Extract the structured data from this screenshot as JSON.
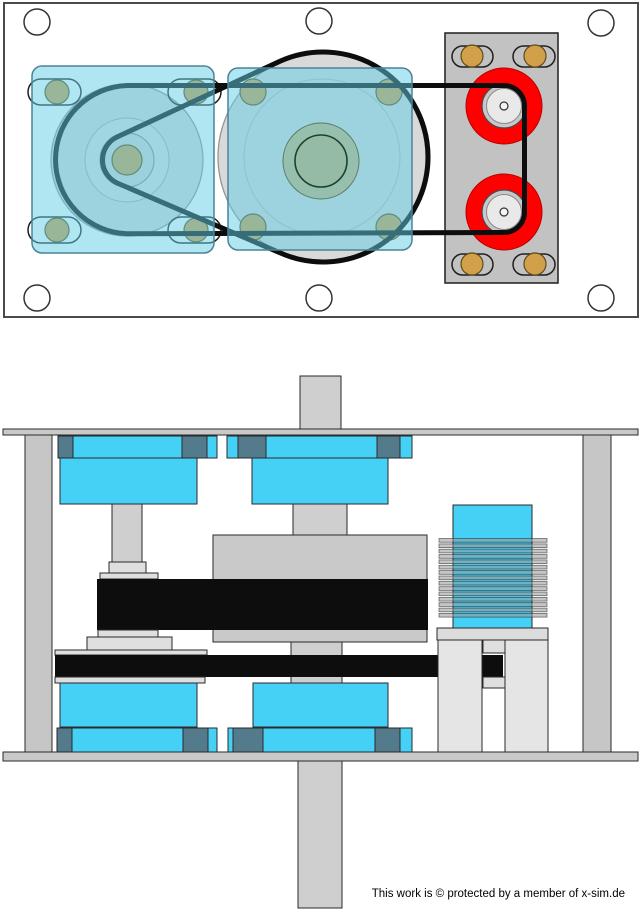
{
  "footer": {
    "text": "This work is © protected by a member of x-sim.de"
  },
  "colors": {
    "cyan-solid": "#45D1F5",
    "cyan-glass": "rgba(96,205,230,0.5)",
    "slate": "#537B8C",
    "red": "#FF0000",
    "brass": "#D2A04A",
    "belt": "#0D0D0D",
    "gray-plate": "#C9C9C9",
    "gray-disc": "#D9D9D9",
    "sage": "#96BBA4",
    "outline": "#4A4A4A"
  }
}
